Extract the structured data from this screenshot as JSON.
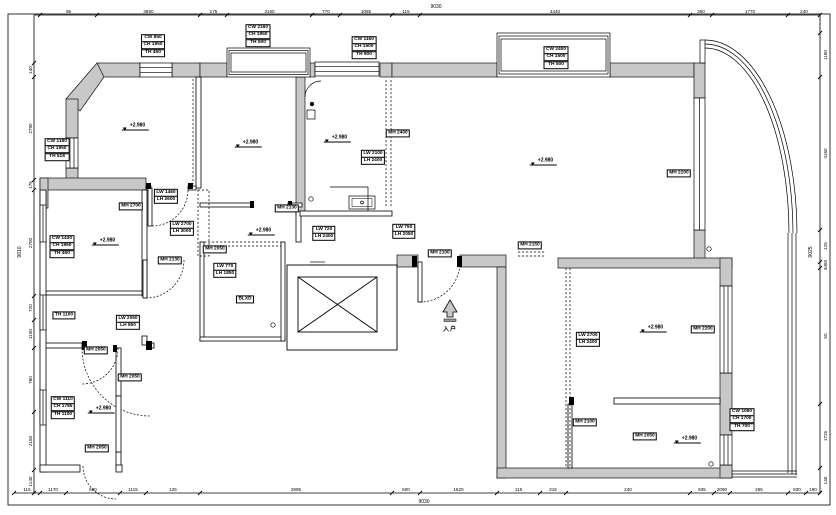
{
  "sheet": {
    "background": "#ffffff",
    "line_color": "#000000",
    "wall_fill": "#c8c8c8"
  },
  "entry": {
    "label": "入户",
    "arrow_icon": "up-arrow"
  },
  "dimensions": {
    "top": {
      "ticks": [
        40,
        97,
        200,
        227,
        312,
        340,
        392,
        420,
        690,
        712,
        788,
        820
      ],
      "labels": [
        "95",
        "3850",
        "175",
        "3160",
        "770",
        "1085",
        "115",
        "4440",
        "360",
        "1770",
        "240"
      ],
      "total": {
        "text": "9030"
      }
    },
    "bottom": {
      "ticks": [
        14,
        40,
        66,
        120,
        146,
        200,
        392,
        420,
        497,
        540,
        566,
        690,
        714,
        730,
        788,
        806,
        820
      ],
      "labels": [
        "115",
        "1170",
        "600",
        "1115",
        "125",
        "2895",
        "600",
        "1620",
        "115",
        "315",
        "240",
        "935",
        "2090",
        "265",
        "930",
        "190"
      ],
      "total": {
        "text": "9030"
      }
    },
    "left": {
      "ticks": [
        63,
        77,
        180,
        190,
        296,
        320,
        348,
        412,
        470,
        493
      ],
      "labels": [
        "140",
        "2790",
        "175",
        "2700",
        "720",
        "1150",
        "760",
        "2150",
        "1140"
      ],
      "total": {
        "text": "9610"
      }
    },
    "right": {
      "ticks": [
        33,
        77,
        230,
        262,
        268,
        404,
        468,
        493
      ],
      "labels": [
        "1180",
        "4160",
        "125",
        "3460",
        "50",
        "1725",
        "140"
      ],
      "total": {
        "text": "9025"
      }
    }
  },
  "levels": [
    {
      "x": 130,
      "y": 130,
      "text": "+2.980"
    },
    {
      "x": 243,
      "y": 147,
      "text": "+2.980"
    },
    {
      "x": 332,
      "y": 142,
      "text": "+2.980"
    },
    {
      "x": 100,
      "y": 245,
      "text": "+2.980"
    },
    {
      "x": 256,
      "y": 235,
      "text": "+2.980"
    },
    {
      "x": 538,
      "y": 165,
      "text": "+2.980"
    },
    {
      "x": 648,
      "y": 332,
      "text": "+2.980"
    },
    {
      "x": 682,
      "y": 443,
      "text": "+2.980"
    },
    {
      "x": 96,
      "y": 413,
      "text": "+2.980"
    }
  ],
  "tags": [
    {
      "x": 153,
      "y": 46,
      "kind": "window",
      "lines": [
        "CW 850",
        "CH 1950",
        "TH 450"
      ]
    },
    {
      "x": 258,
      "y": 36,
      "kind": "window",
      "lines": [
        "CW 2160",
        "CH 1950",
        "TH 500"
      ]
    },
    {
      "x": 364,
      "y": 48,
      "kind": "window",
      "lines": [
        "CW 1160",
        "CH 1500",
        "TH 900"
      ]
    },
    {
      "x": 556,
      "y": 58,
      "kind": "window",
      "lines": [
        "CW 2400",
        "CH 1500",
        "TH 500"
      ]
    },
    {
      "x": 57,
      "y": 150,
      "kind": "window",
      "lines": [
        "CW 1180",
        "CH 1950",
        "TH 518"
      ]
    },
    {
      "x": 62,
      "y": 247,
      "kind": "window",
      "lines": [
        "CW 1430",
        "CH 1950",
        "TH 450"
      ]
    },
    {
      "x": 63,
      "y": 408,
      "kind": "window",
      "lines": [
        "CW 1110",
        "CH 1785",
        "TH 1100"
      ]
    },
    {
      "x": 679,
      "y": 174,
      "kind": "door",
      "lines": [
        "MH 2200"
      ]
    },
    {
      "x": 131,
      "y": 207,
      "kind": "door",
      "lines": [
        "MH 2700"
      ]
    },
    {
      "x": 287,
      "y": 209,
      "kind": "door",
      "lines": [
        "MH 2130"
      ]
    },
    {
      "x": 166,
      "y": 197,
      "kind": "opening",
      "lines": [
        "LW 1460",
        "LH 2600"
      ]
    },
    {
      "x": 182,
      "y": 229,
      "kind": "opening",
      "lines": [
        "LW 2700",
        "LH 3000"
      ]
    },
    {
      "x": 225,
      "y": 271,
      "kind": "opening",
      "lines": [
        "LW 770",
        "LH 1850"
      ]
    },
    {
      "x": 215,
      "y": 250,
      "kind": "door",
      "lines": [
        "MH 2050"
      ]
    },
    {
      "x": 170,
      "y": 261,
      "kind": "door",
      "lines": [
        "MH 2130"
      ]
    },
    {
      "x": 373,
      "y": 158,
      "kind": "opening",
      "lines": [
        "LW 2100",
        "LH 2400"
      ]
    },
    {
      "x": 398,
      "y": 134,
      "kind": "door",
      "lines": [
        "MH 2400"
      ]
    },
    {
      "x": 324,
      "y": 234,
      "kind": "opening",
      "lines": [
        "LW 720",
        "LH 2400"
      ]
    },
    {
      "x": 404,
      "y": 232,
      "kind": "opening",
      "lines": [
        "LW 750",
        "LH 2050"
      ]
    },
    {
      "x": 440,
      "y": 254,
      "kind": "door",
      "lines": [
        "MH 2100"
      ]
    },
    {
      "x": 530,
      "y": 246,
      "kind": "door",
      "lines": [
        "MH 2150"
      ]
    },
    {
      "x": 588,
      "y": 340,
      "kind": "opening",
      "lines": [
        "LW 2700",
        "LH 2400"
      ]
    },
    {
      "x": 703,
      "y": 330,
      "kind": "door",
      "lines": [
        "MH 2200"
      ]
    },
    {
      "x": 645,
      "y": 437,
      "kind": "door",
      "lines": [
        "MH 2050"
      ]
    },
    {
      "x": 585,
      "y": 423,
      "kind": "door",
      "lines": [
        "MH 2100"
      ]
    },
    {
      "x": 742,
      "y": 420,
      "kind": "window",
      "lines": [
        "CW 1060",
        "CH 1700",
        "TH 700"
      ]
    },
    {
      "x": 96,
      "y": 351,
      "kind": "door",
      "lines": [
        "MH 2050"
      ]
    },
    {
      "x": 130,
      "y": 378,
      "kind": "door",
      "lines": [
        "MH 2050"
      ]
    },
    {
      "x": 97,
      "y": 449,
      "kind": "door",
      "lines": [
        "MH 2050"
      ]
    },
    {
      "x": 64,
      "y": 316,
      "kind": "label",
      "lines": [
        "TH 1100"
      ]
    },
    {
      "x": 128,
      "y": 323,
      "kind": "opening",
      "lines": [
        "LW 2050",
        "LH 950"
      ]
    },
    {
      "x": 245,
      "y": 300,
      "kind": "label",
      "lines": [
        "BLXD"
      ]
    }
  ]
}
